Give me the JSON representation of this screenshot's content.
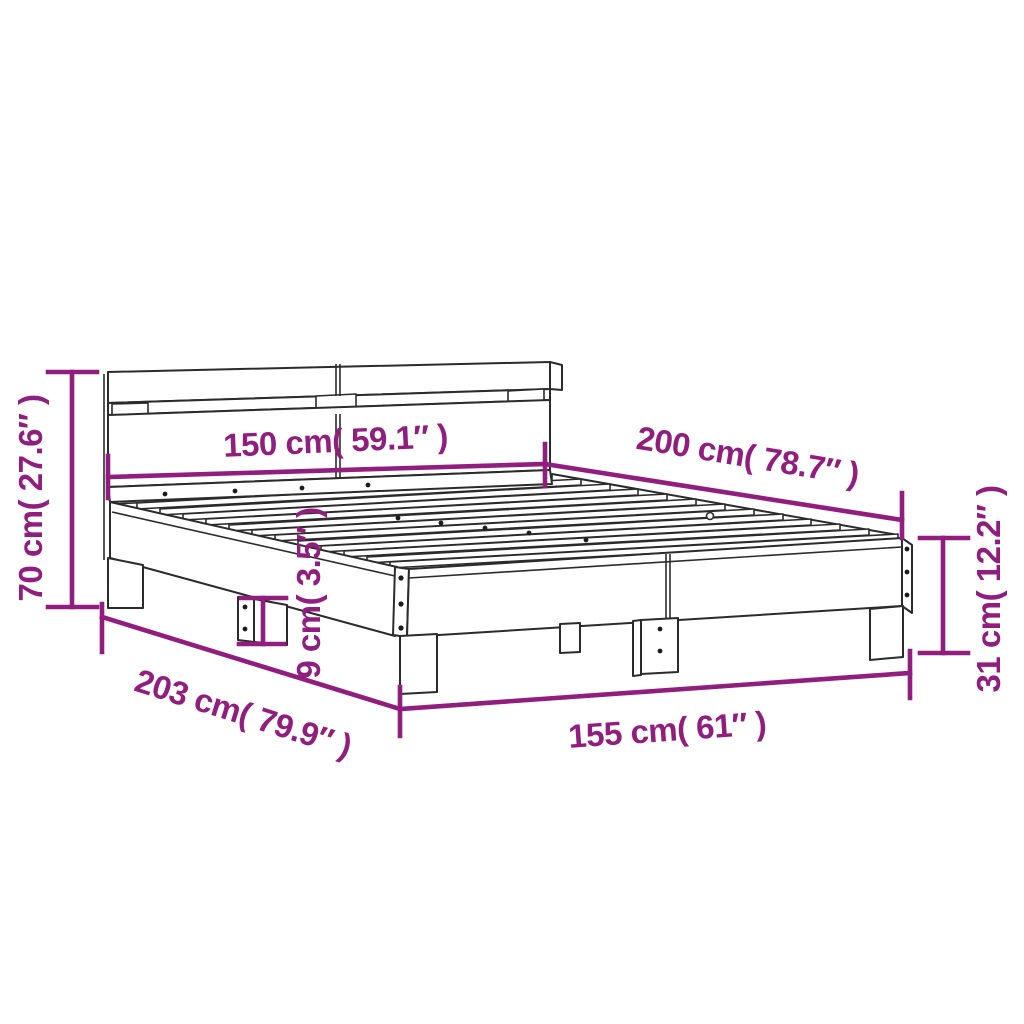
{
  "diagram": {
    "title": "Bed frame with headboard - dimensions diagram",
    "colors": {
      "dimension_annotation": "#911d7e",
      "line_art": "#2b2b2b",
      "background": "#ffffff"
    },
    "dimensions": {
      "headboard_width": "150 cm( 59.1″ )",
      "bed_length": "200 cm( 78.7″ )",
      "headboard_height": "70 cm( 27.6″ )",
      "frame_length": "203 cm( 79.9″ )",
      "frame_width": "155 cm( 61″ )",
      "leg_height": "9 cm( 3.5″ )",
      "rail_height": "31 cm( 12.2″ )"
    }
  }
}
